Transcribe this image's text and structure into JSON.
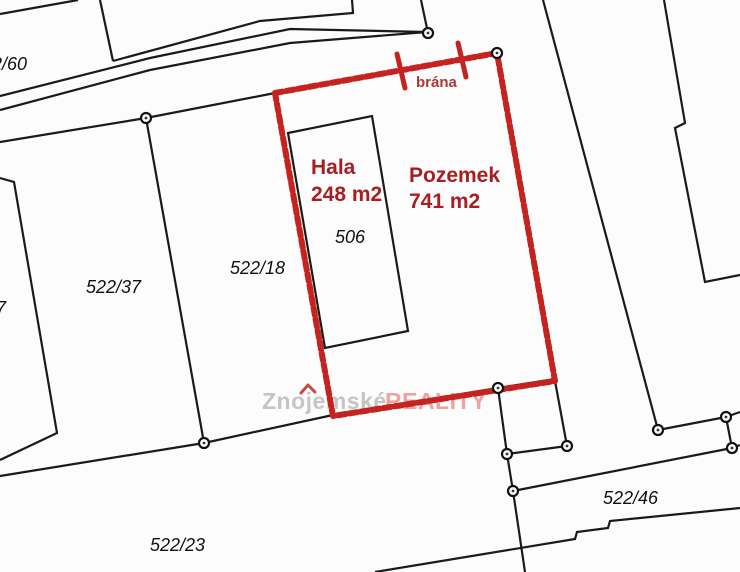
{
  "map": {
    "type": "cadastral-parcel-map",
    "colors": {
      "boundary_highlight": "#c42320",
      "label_highlight": "#a81e22",
      "gate_label_color": "#a93a36",
      "watermark_gray": "#c5c5c5",
      "watermark_pink": "#eca4a0",
      "line_color": "#1a1a1a",
      "background": "#fcfcfc"
    },
    "parcels": [
      {
        "label": "2/60"
      },
      {
        "label": "522/37"
      },
      {
        "label": "7"
      },
      {
        "label": "522/18"
      },
      {
        "label": "522/23"
      },
      {
        "label": "522/46"
      }
    ],
    "buildings": [
      {
        "label": "506"
      }
    ],
    "highlight": {
      "building_name": "Hala",
      "building_area": "248 m2",
      "parcel_name": "Pozemek",
      "parcel_area": "741 m2",
      "gate_label": "brána"
    },
    "watermark": {
      "brand_prefix": "Znojemské",
      "brand_suffix": "REALITY"
    }
  }
}
